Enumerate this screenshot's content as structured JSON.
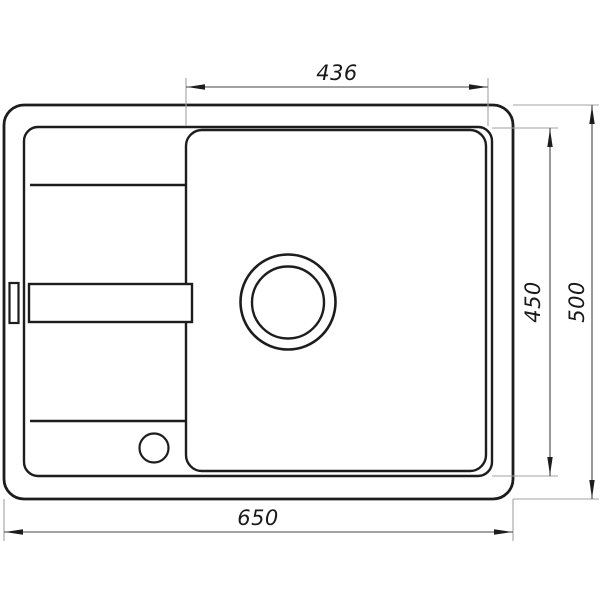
{
  "diagram": {
    "dimension_labels": {
      "basin_width": "436",
      "basin_depth": "450",
      "overall_depth": "500",
      "overall_width": "650"
    },
    "colors": {
      "background": "#ffffff",
      "object_line": "#1d1d1d",
      "dimension_line": "#454545",
      "extension_line": "#a3a3a3",
      "text": "#1a1a1a"
    }
  }
}
